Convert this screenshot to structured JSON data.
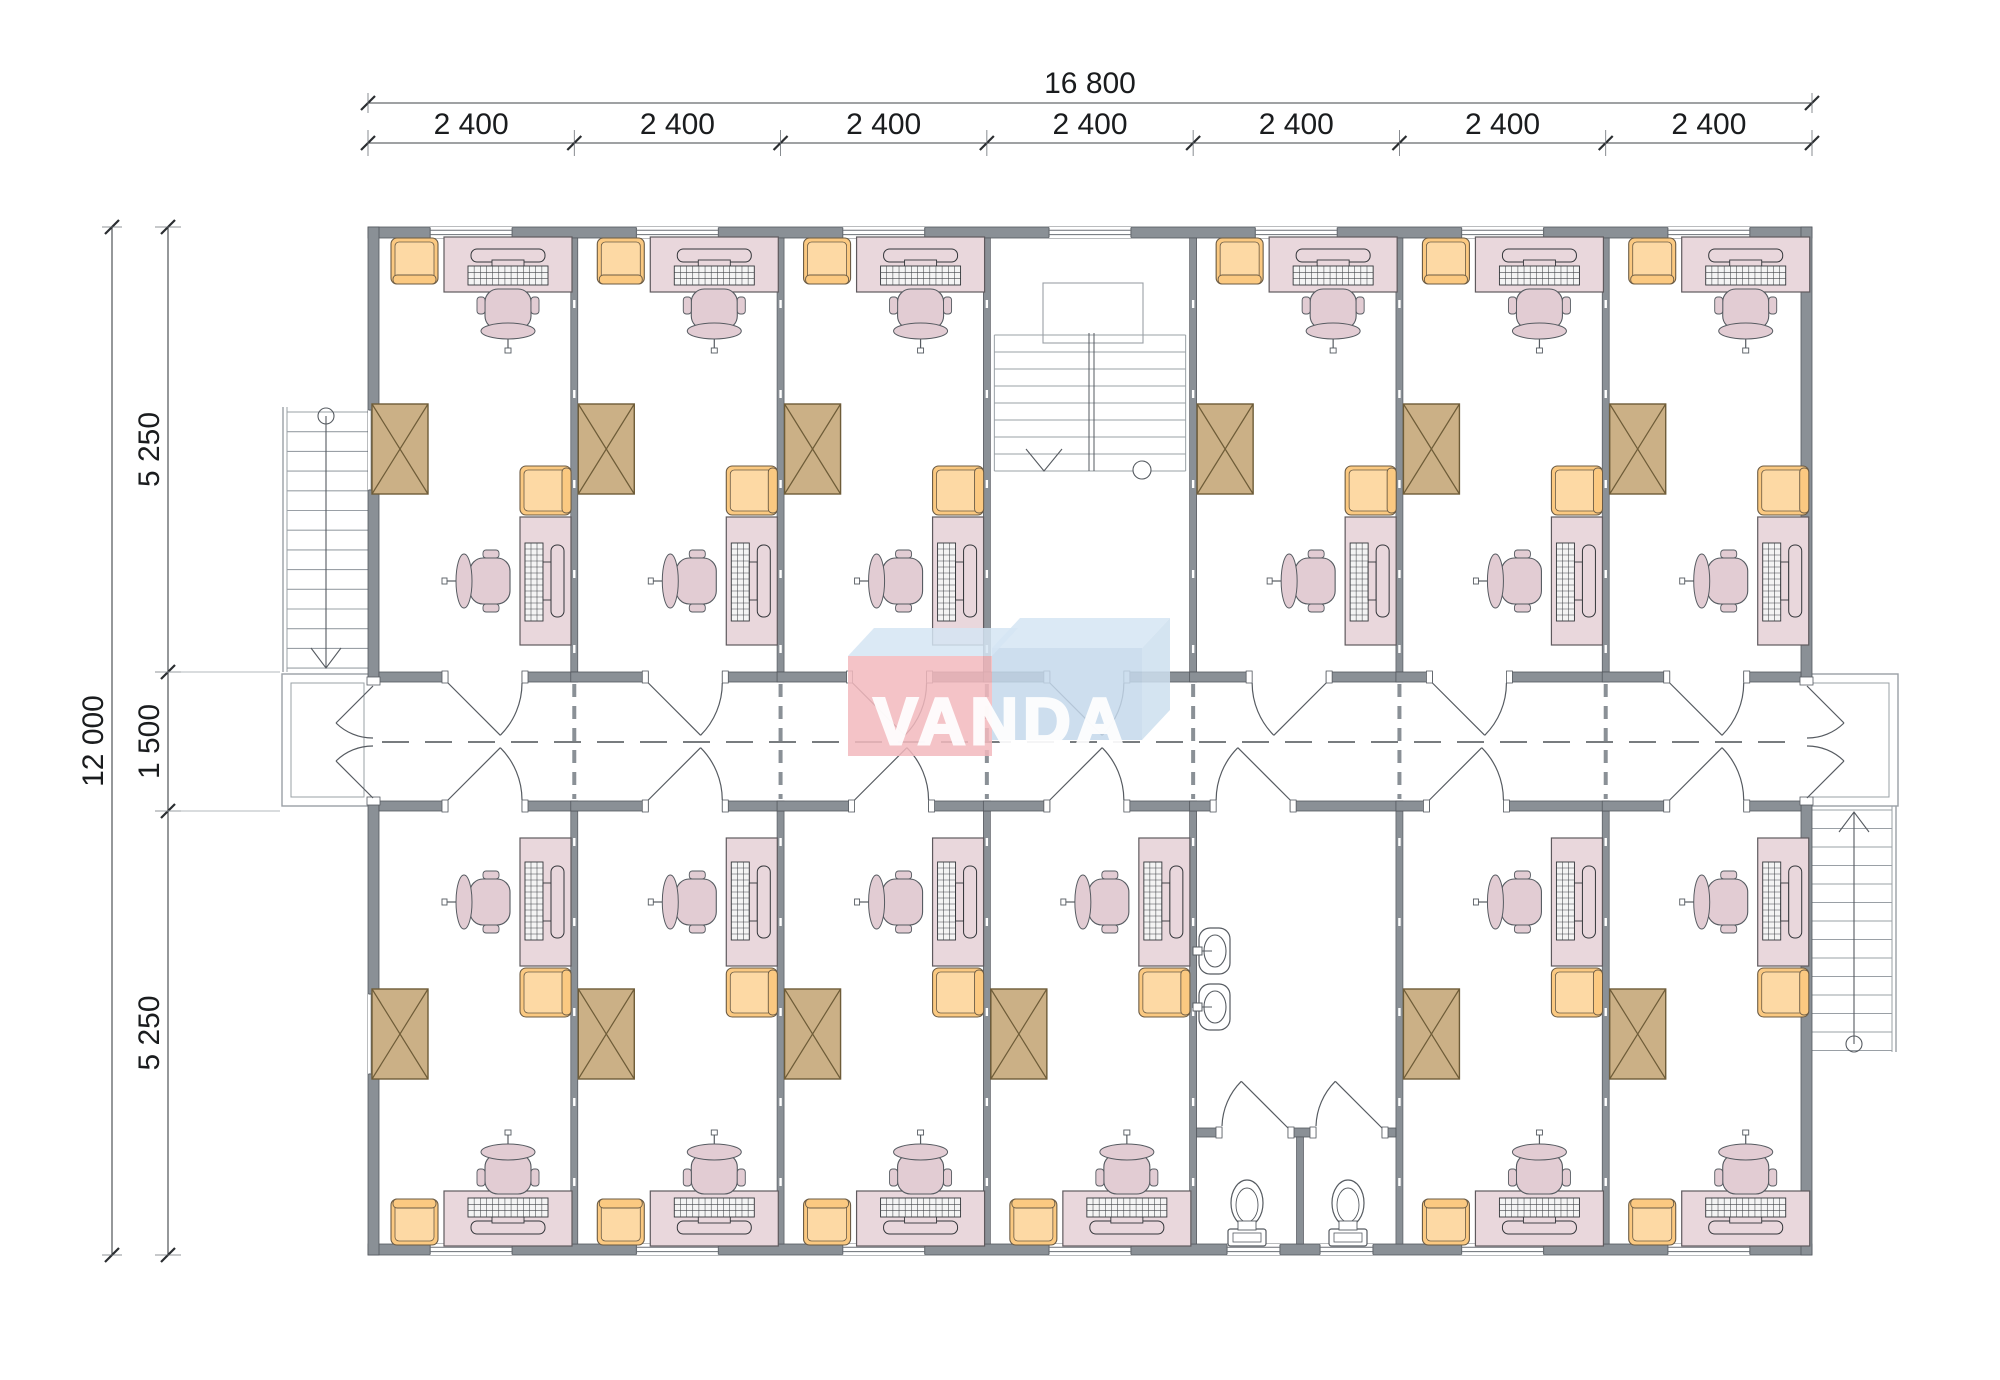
{
  "plan": {
    "title_watermark": "VANDA"
  },
  "dimensions": {
    "total_width_label": "16 800",
    "bay_width_labels": [
      "2 400",
      "2 400",
      "2 400",
      "2 400",
      "2 400",
      "2 400",
      "2 400"
    ],
    "total_height_label": "12 000",
    "height_segment_labels": [
      "5 250",
      "1 500",
      "5 250"
    ]
  },
  "layout": {
    "building": {
      "x": 368,
      "y": 227,
      "w": 1444,
      "h": 1028
    },
    "bays": 7,
    "wall_thickness": 11,
    "partition_thickness": 7,
    "corridor": {
      "top_wall_y": 672,
      "bottom_wall_y": 801,
      "wall_t": 10,
      "center_y": 742
    },
    "mirror_y": 1483,
    "door_width": 74,
    "dim_lines": {
      "top_total_y": 103,
      "top_seg_y": 143,
      "left_total_x": 112,
      "left_seg_x": 168
    }
  },
  "rooms": [
    {
      "bay": 0,
      "row": "top",
      "type": "office",
      "door": {
        "off": 80,
        "hinge": "left"
      }
    },
    {
      "bay": 1,
      "row": "top",
      "type": "office",
      "door": {
        "off": 74,
        "hinge": "left"
      }
    },
    {
      "bay": 2,
      "row": "top",
      "type": "office",
      "door": {
        "off": 72,
        "hinge": "left"
      }
    },
    {
      "bay": 3,
      "row": "top",
      "type": "stairwell",
      "door": {
        "off": 63,
        "hinge": "left"
      }
    },
    {
      "bay": 4,
      "row": "top",
      "type": "office",
      "door": {
        "off": 59,
        "hinge": "right"
      }
    },
    {
      "bay": 5,
      "row": "top",
      "type": "office",
      "door": {
        "off": 33,
        "hinge": "left"
      }
    },
    {
      "bay": 6,
      "row": "top",
      "type": "office",
      "door": {
        "off": 64,
        "hinge": "left"
      }
    },
    {
      "bay": 0,
      "row": "bottom",
      "type": "office",
      "door": {
        "off": 80,
        "hinge": "left"
      }
    },
    {
      "bay": 1,
      "row": "bottom",
      "type": "office",
      "door": {
        "off": 74,
        "hinge": "left"
      }
    },
    {
      "bay": 2,
      "row": "bottom",
      "type": "office",
      "door": {
        "off": 74,
        "hinge": "left"
      }
    },
    {
      "bay": 3,
      "row": "bottom",
      "type": "office",
      "door": {
        "off": 63,
        "hinge": "left"
      }
    },
    {
      "bay": 4,
      "row": "bottom",
      "type": "washroom",
      "door": {
        "off": 23,
        "hinge": "right"
      }
    },
    {
      "bay": 5,
      "row": "bottom",
      "type": "office",
      "door": {
        "off": 30,
        "hinge": "left"
      }
    },
    {
      "bay": 6,
      "row": "bottom",
      "type": "office",
      "door": {
        "off": 64,
        "hinge": "left"
      }
    }
  ],
  "office_furniture": [
    {
      "kind": "armchair",
      "slot": "corner-by-window"
    },
    {
      "kind": "desk-computer",
      "slot": "window-wall"
    },
    {
      "kind": "office-chair",
      "slot": "at-window-desk"
    },
    {
      "kind": "storage-box",
      "slot": "left-wall"
    },
    {
      "kind": "armchair",
      "slot": "right-wall"
    },
    {
      "kind": "desk-computer",
      "slot": "right-wall"
    },
    {
      "kind": "office-chair",
      "slot": "at-right-desk"
    }
  ],
  "washroom_fixtures": [
    "sink",
    "sink",
    "toilet",
    "toilet"
  ],
  "stairs": [
    "exterior-stair-west",
    "interior-stairwell",
    "exterior-stair-east"
  ],
  "colors": {
    "wall_fill": "#8a9096",
    "wall_stroke": "#54585e",
    "thin_line": "#6a6f75",
    "stair_line": "#9aa0a6",
    "dim_line": "#3f4347",
    "text": "#1a1c1e",
    "desk_fill": "#e9d7dc",
    "desk_stroke": "#5f5a5e",
    "chair_fill": "#e2ccd3",
    "orange_fill": "#fbc981",
    "orange_light": "#fdd9a4",
    "orange_stroke": "#6b5b44",
    "box_fill": "#cbb086",
    "box_stroke": "#6e5c38",
    "fixture_line": "#565b61",
    "logo_pink": "rgba(242,184,189,0.85)",
    "logo_blue": "rgba(196,216,235,0.85)",
    "logo_top_face": "rgba(213,229,243,0.85)",
    "logo_side_face": "rgba(205,223,239,0.85)",
    "logo_text": "#ffffff"
  }
}
